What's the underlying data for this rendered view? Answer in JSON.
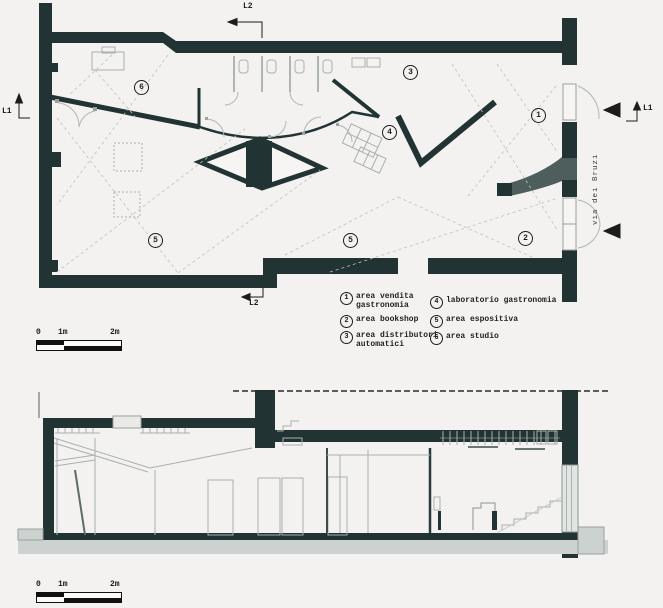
{
  "colors": {
    "wall": "#213433",
    "background": "#f3f2f0",
    "ramp_gray": "#4e5e5d",
    "slab_gray": "#ccd2cf",
    "line_gray": "#a9b0ae",
    "text": "#1c1c1c"
  },
  "plan": {
    "room_labels": [
      "6",
      "3",
      "4",
      "1",
      "5",
      "5",
      "2"
    ],
    "street_label": "via dei Bruzi",
    "markers": {
      "l1_left": "L1",
      "l2_top": "L2",
      "l2_bottom": "L2",
      "l1_right": "L1"
    }
  },
  "legend": {
    "items": [
      {
        "num": "1",
        "label": "area vendita gastronomia"
      },
      {
        "num": "2",
        "label": "area bookshop"
      },
      {
        "num": "3",
        "label": "area distributori automatici"
      },
      {
        "num": "4",
        "label": "laboratorio gastronomia"
      },
      {
        "num": "5",
        "label": "area espositiva"
      },
      {
        "num": "6",
        "label": "area studio"
      }
    ]
  },
  "scale_bars": [
    {
      "ticks": [
        "0",
        "1m",
        "2m"
      ]
    },
    {
      "ticks": [
        "0",
        "1m",
        "2m"
      ]
    }
  ]
}
